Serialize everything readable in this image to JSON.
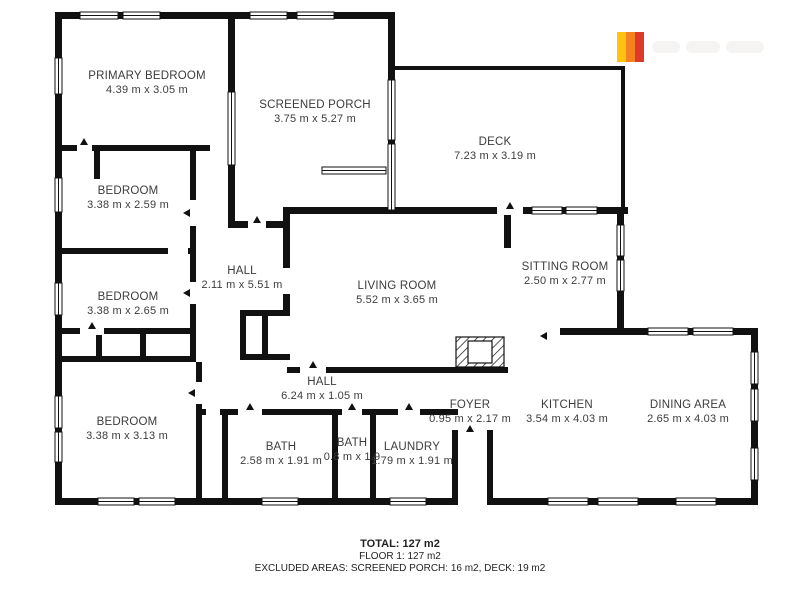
{
  "rooms": [
    {
      "id": "primary-bedroom",
      "name": "PRIMARY BEDROOM",
      "dims": "4.39 m x 3.05 m"
    },
    {
      "id": "screened-porch",
      "name": "SCREENED PORCH",
      "dims": "3.75 m x 5.27 m"
    },
    {
      "id": "deck",
      "name": "DECK",
      "dims": "7.23 m x 3.19 m"
    },
    {
      "id": "bedroom-2",
      "name": "BEDROOM",
      "dims": "3.38 m x 2.59 m"
    },
    {
      "id": "bedroom-3",
      "name": "BEDROOM",
      "dims": "3.38 m x 2.65 m"
    },
    {
      "id": "hall-upper",
      "name": "HALL",
      "dims": "2.11 m x 5.51 m"
    },
    {
      "id": "living-room",
      "name": "LIVING ROOM",
      "dims": "5.52 m x 3.65 m"
    },
    {
      "id": "sitting-room",
      "name": "SITTING ROOM",
      "dims": "2.50 m x 2.77 m"
    },
    {
      "id": "bedroom-4",
      "name": "BEDROOM",
      "dims": "3.38 m x 3.13 m"
    },
    {
      "id": "hall-lower",
      "name": "HALL",
      "dims": "6.24 m x 1.05 m"
    },
    {
      "id": "foyer",
      "name": "FOYER",
      "dims": "0.95 m x 2.17 m"
    },
    {
      "id": "kitchen",
      "name": "KITCHEN",
      "dims": "3.54 m x 4.03 m"
    },
    {
      "id": "dining-area",
      "name": "DINING AREA",
      "dims": "2.65 m x 4.03 m"
    },
    {
      "id": "bath-1",
      "name": "BATH",
      "dims": "2.58 m x 1.91 m"
    },
    {
      "id": "bath-2",
      "name": "BATH",
      "dims": "0.8 m x 1.9"
    },
    {
      "id": "laundry",
      "name": "LAUNDRY",
      "dims": "1.79 m x 1.91 m"
    }
  ],
  "summary": {
    "total": "TOTAL: 127 m2",
    "floor": "FLOOR 1: 127 m2",
    "excluded": "EXCLUDED AREAS: SCREENED PORCH: 16 m2, DECK: 19 m2"
  },
  "logo": {
    "stripe_colors": [
      "#FFC20E",
      "#F58220",
      "#DD3A2A"
    ]
  },
  "colors": {
    "wall": "#111111",
    "window_fill": "#ffffff",
    "label_text": "#3c3c3c"
  }
}
